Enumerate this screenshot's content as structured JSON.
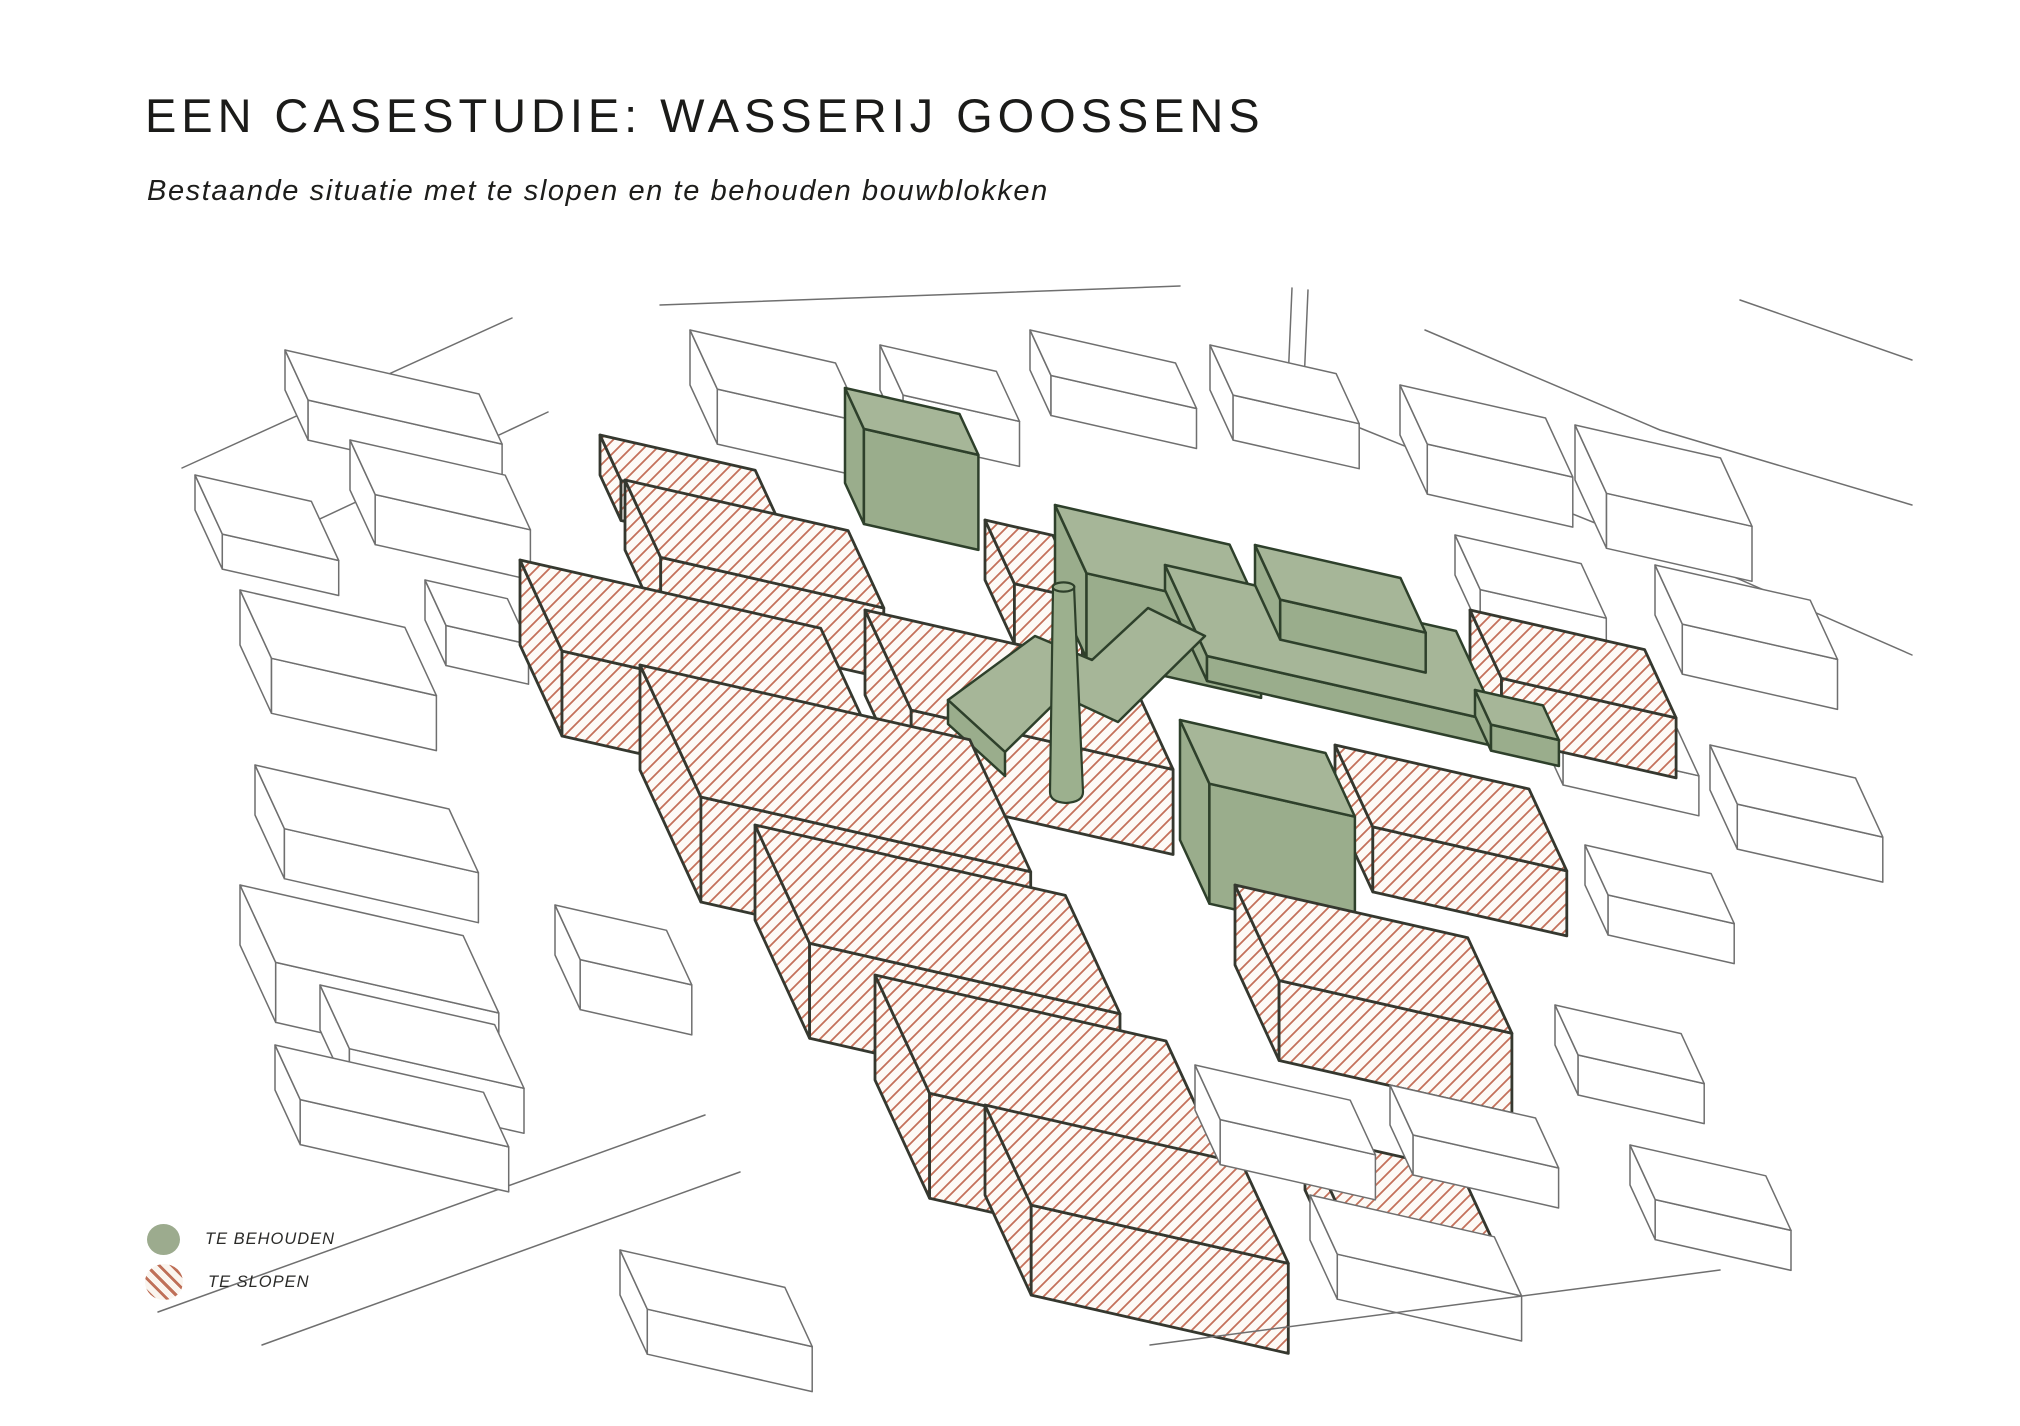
{
  "slide": {
    "title": "EEN CASESTUDIE: WASSERIJ GOOSSENS",
    "subtitle": "Bestaande situatie met  te slopen en te behouden bouwblokken"
  },
  "legend": {
    "items": [
      {
        "label": "TE BEHOUDEN",
        "swatch": "green-circle",
        "color": "#9cab8e"
      },
      {
        "label": "TE SLOPEN",
        "swatch": "red-hatch-circle",
        "color": "#bf7058"
      }
    ]
  },
  "figure": {
    "colors": {
      "keep_green": "#a6b698",
      "demolish_hatch_red": "#c4705a",
      "site_outline": "#35382f",
      "context_line": "#6f6f6f",
      "background": "#ffffff",
      "text": "#1d1d1b"
    }
  }
}
